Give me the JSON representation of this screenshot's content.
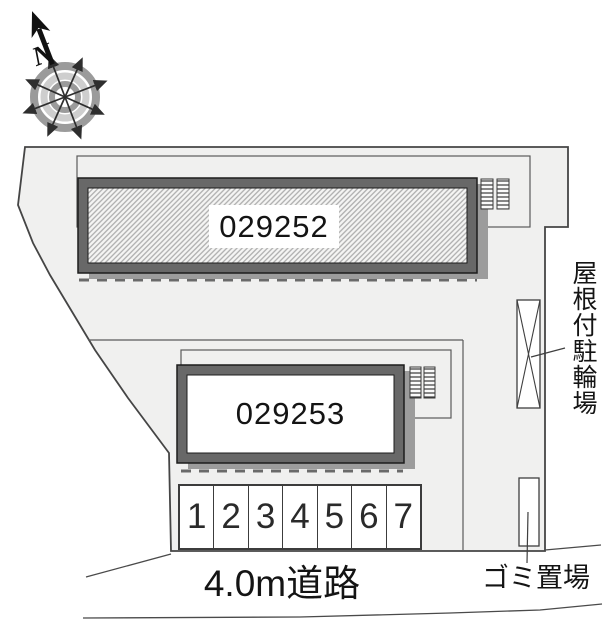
{
  "compass": {
    "north_label": "N"
  },
  "buildings": [
    {
      "label": "029252",
      "fill": "hatched"
    },
    {
      "label": "029253",
      "fill": "plain"
    }
  ],
  "parking": {
    "spaces": [
      "1",
      "2",
      "3",
      "4",
      "5",
      "6",
      "7"
    ]
  },
  "labels": {
    "road": "4.0m道路",
    "covered_bicycle_parking": "屋根付駐輪場",
    "garbage_area": "ゴミ置場"
  },
  "colors": {
    "site_fill": "#f0f0ef",
    "site_outline": "#454545",
    "building_band": "#686868",
    "building_edge": "#1c1c1c",
    "hatch_line": "#aeaeae",
    "shadow": "#9c9c9c",
    "text": "#141414"
  }
}
